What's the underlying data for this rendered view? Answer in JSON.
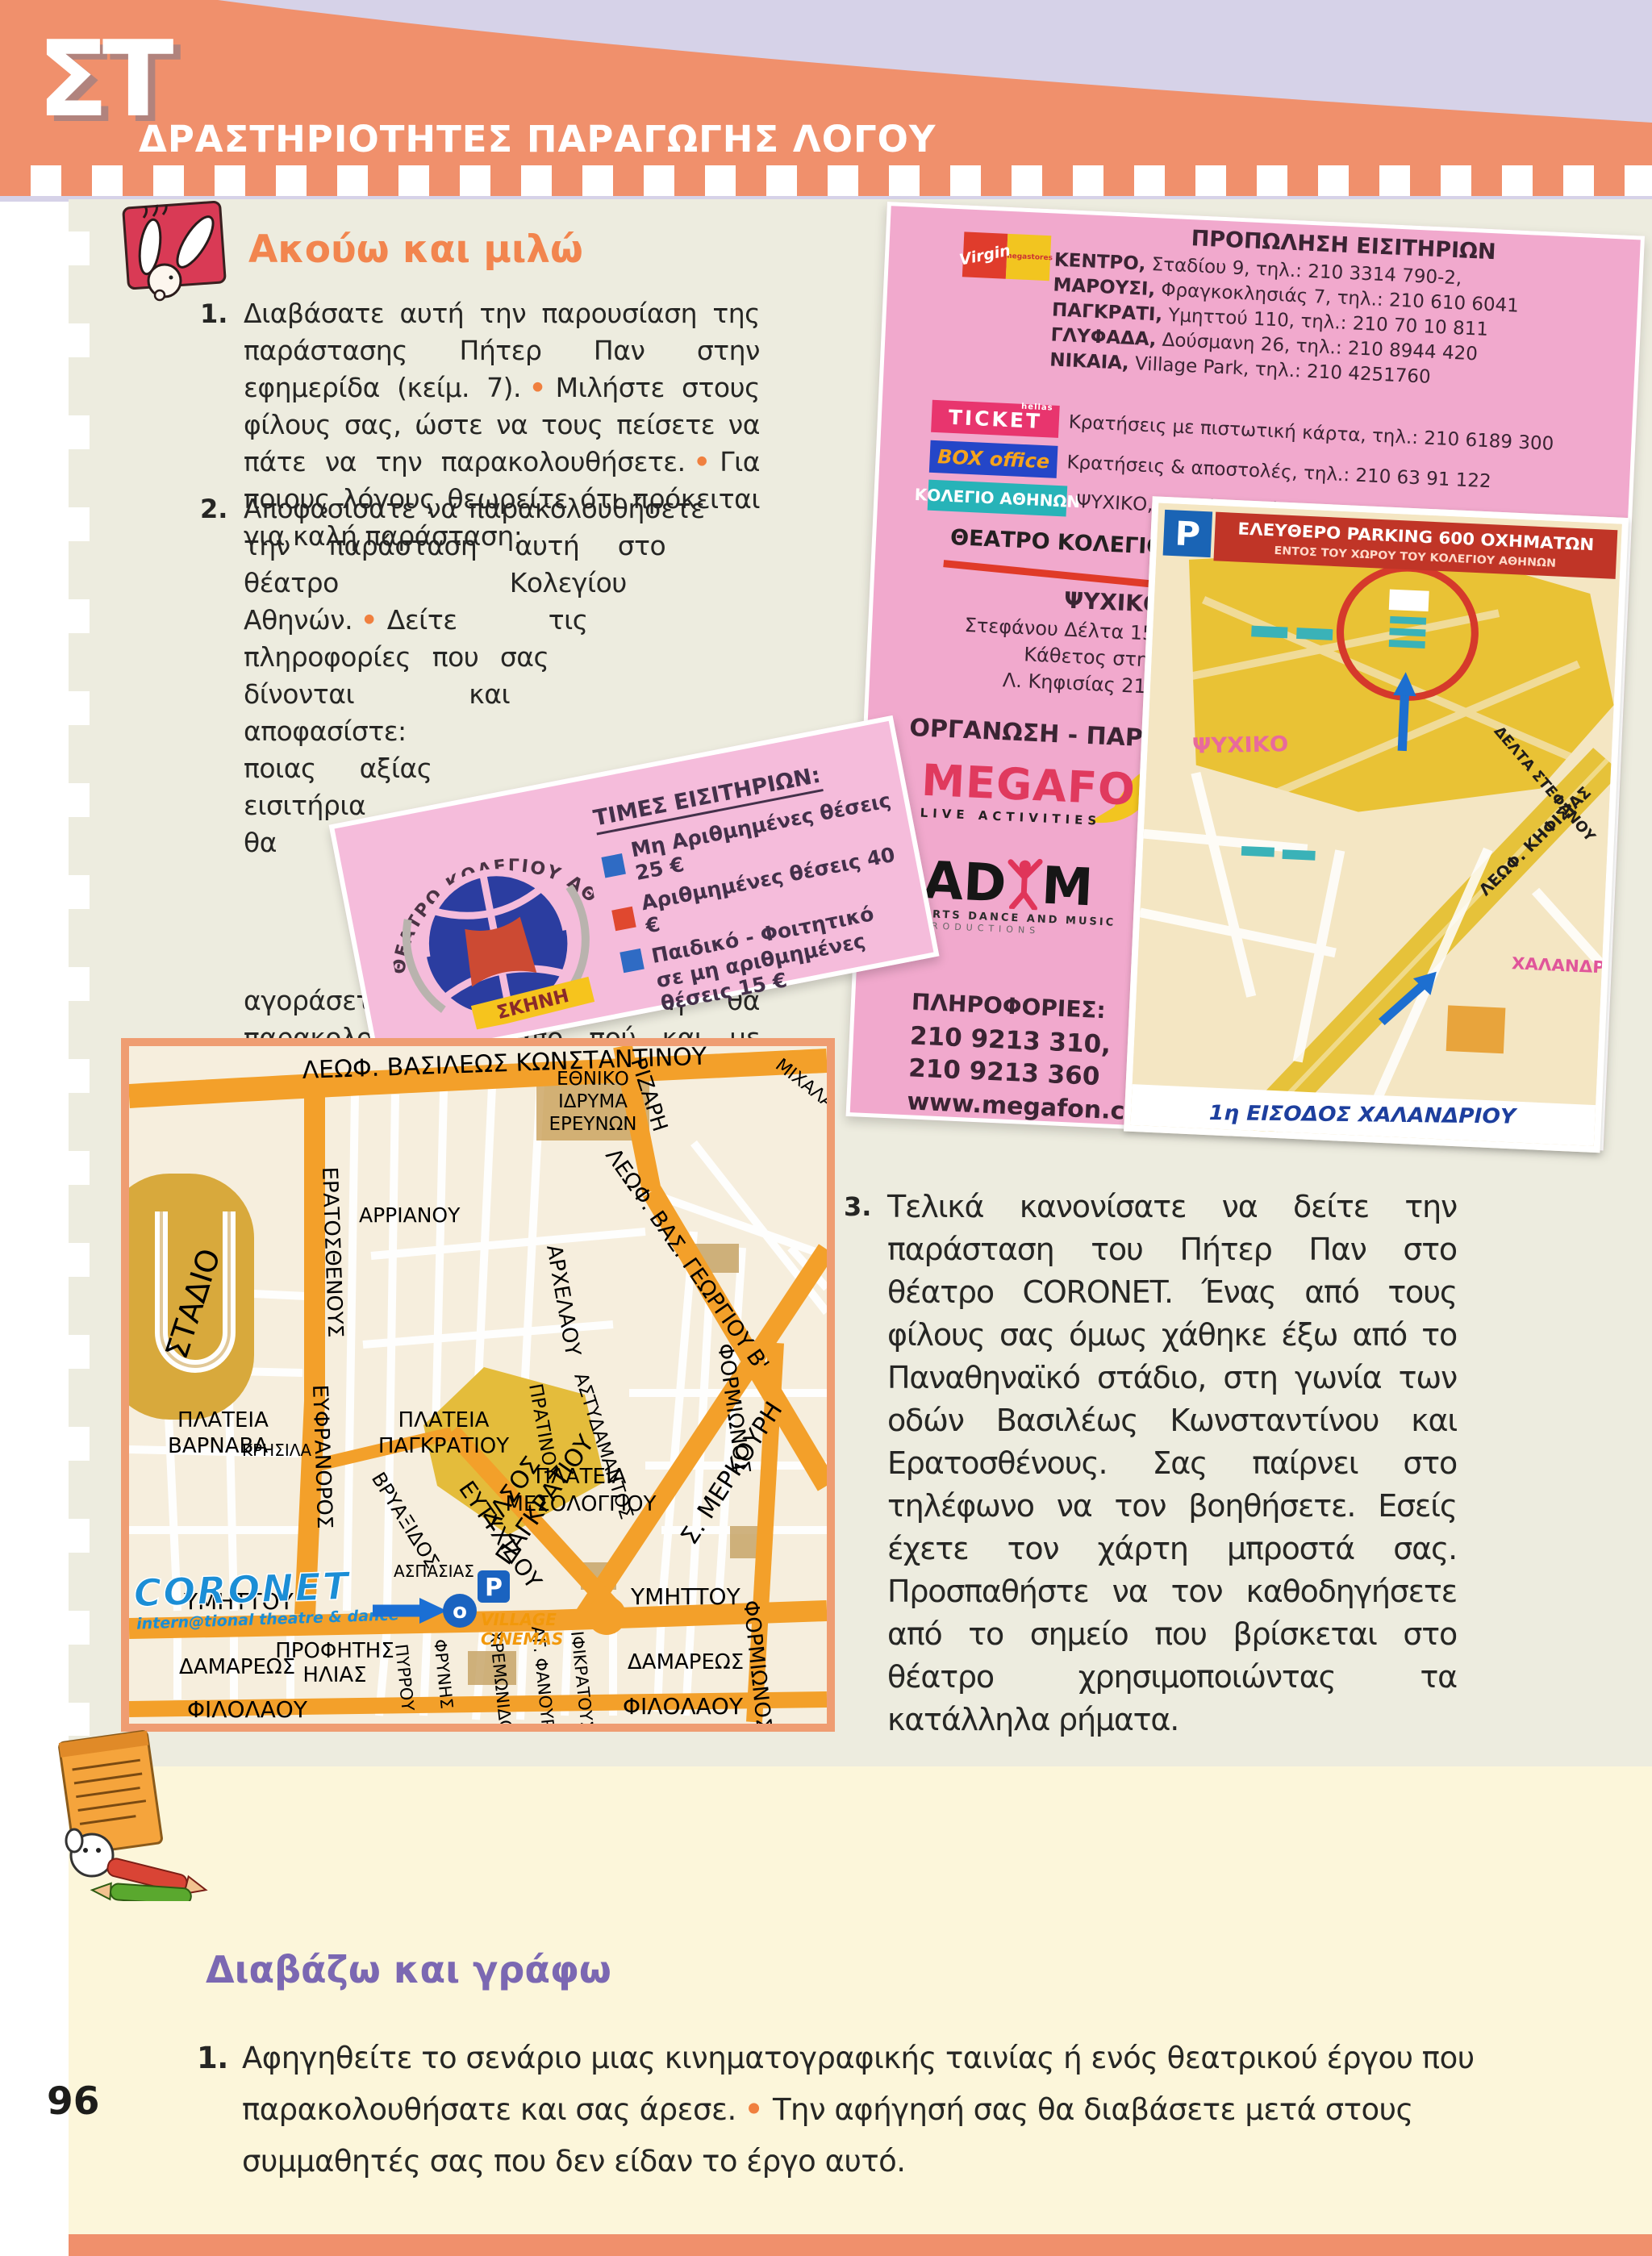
{
  "page": {
    "number": "96"
  },
  "header": {
    "badge": "ΣΤ",
    "title": "ΔΡΑΣΤΗΡΙΟΤΗΤΕΣ ΠΑΡΑΓΩΓΗΣ ΛΟΓΟΥ"
  },
  "listen_speak": {
    "heading": "Ακούω και μιλώ",
    "item1": {
      "num": "1.",
      "p1": "Διαβάσατε αυτή την παρουσίαση της παράστασης Πήτερ Παν στην εφημερίδα (κείμ. 7).",
      "p2": "Μιλήστε στους φίλους σας, ώστε να τους πείσετε να πάτε να την παρακολουθήσετε.",
      "p3": "Για ποιους λόγους θεωρείτε ότι πρόκειται για καλή παράσταση;"
    },
    "item2": {
      "num": "2.",
      "p1": "Αποφασίσατε να παρακολουθήσετε την παράσταση αυτή στο θέατρο Κολεγίου Αθηνών.",
      "p2": "Δείτε τις πληροφορίες που σας δίνονται και αποφασίστε: ποιας αξίας εισιτήρια θα αγοράσετε, ποια παράσταση θα παρακολουθήσετε, από πού και με ποιον τρόπο θα προμηθευτείτε τα εισιτήριά σας."
    },
    "item3": {
      "num": "3.",
      "p1": "Τελικά κανονίσατε να δείτε την παράσταση του Πήτερ Παν στο θέατρο CORONET. Ένας από τους φίλους σας όμως χάθηκε έξω από το Παναθηναϊκό στάδιο, στη γωνία των οδών Βασιλέως Κωνσταντίνου και Ερατοσθένους. Σας παίρνει στο τηλέφωνο να τον βοηθήσετε. Εσείς έχετε τον χάρτη μπροστά σας. Προσπαθήστε να τον καθοδηγήσετε από το σημείο που βρίσκεται στο θέατρο χρησιμοποιώντας τα κατάλληλα ρήματα."
    }
  },
  "flyer": {
    "virgin": {
      "name": "Virgin",
      "sub": "megastores"
    },
    "presale_title": "ΠΡΟΠΩΛΗΣΗ ΕΙΣΙΤΗΡΙΩΝ",
    "loc1": {
      "name": "ΚΕΝΤΡΟ,",
      "rest": " Σταδίου 9, τηλ.: 210 3314 790-2,"
    },
    "loc2": {
      "name": "ΜΑΡΟΥΣΙ,",
      "rest": " Φραγκοκλησιάς 7, τηλ.: 210 610 6041"
    },
    "loc3": {
      "name": "ΠΑΓΚΡΑΤΙ,",
      "rest": " Υμηττού 110, τηλ.: 210 70 10 811"
    },
    "loc4": {
      "name": "ΓΛΥΦΑΔΑ,",
      "rest": " Δούσμανη 26, τηλ.: 210 8944 420"
    },
    "loc5": {
      "name": "ΝΙΚΑΙΑ,",
      "rest": " Village Park, τηλ.: 210 4251760"
    },
    "ticket": {
      "main": "TICKET",
      "sub": "hellas",
      "text": "Κρατήσεις με πιστωτική κάρτα, τηλ.: 210 6189 300"
    },
    "boxoffice": {
      "main": "BOX office",
      "text": "Κρατήσεις & αποστολές, τηλ.: 210 63 91 122"
    },
    "kolegio": {
      "main": "ΚΟΛΕΓΙΟ ΑΘΗΝΩΝ",
      "text": "ΨΥΧΙΚΟ, Στεφάνου Δέλτα 15, τηλ.:210 6798100"
    },
    "theater": {
      "title": "ΘΕΑΤΡΟ ΚΟΛΕΓΙΟΥ ΑΘΗΝΩΝ",
      "area": "ΨΥΧΙΚΟ",
      "a1": "Στεφάνου Δέλτα 15,",
      "a2": "Κάθετος στην",
      "a3": "Λ. Κηφισίας 215"
    },
    "org": "ΟΡΓΑΝΩΣΗ - ΠΑΡΑΓΩΓΗ",
    "megafon": {
      "name": "MEGAFON",
      "sub": "LIVE ACTIVITIES"
    },
    "adam": {
      "a": "AD",
      "m": "M",
      "sub1": "ARTS DANCE AND MUSIC",
      "sub2": "PRODUCTIONS"
    },
    "info": {
      "label": "ΠΛΗΡΟΦΟΡΙΕΣ:",
      "tel1": "210 9213 310,",
      "tel2": "210 9213 360",
      "web": "www.megafon.com"
    },
    "mini_map": {
      "p": "P",
      "parking1": "ΕΛΕΥΘΕΡΟ PARKING 600 ΟΧΗΜΑΤΩΝ",
      "parking2": "ΕΝΤΟΣ ΤΟΥ ΧΩΡΟΥ ΤΟΥ ΚΟΛΕΓΙΟΥ ΑΘΗΝΩΝ",
      "psychiko": "ΨΥΧΙΚΟ",
      "delta": "ΔΕΛΤΑ ΣΤΕΦΑΝΟΥ",
      "kifisias": "ΛΕΩΦ. ΚΗΦΙΣΙΑΣ",
      "chalandri": "ΧΑΛΑΝΔΡΙ",
      "entrance": "1η ΕΙΣΟΔΟΣ ΧΑΛΑΝΔΡΙΟΥ"
    }
  },
  "price_card": {
    "arc_title": "ΘΕΑΤΡΟ ΚΟΛΕΓΙΟΥ ΑΘΗΝΩΝ",
    "stage": "ΣΚΗΝΗ",
    "title": "ΤΙΜΕΣ ΕΙΣΙΤΗΡΙΩΝ:",
    "row1": "Μη Αριθμημένες θέσεις 25 €",
    "row2": "Αριθμημένες θέσεις 40 €",
    "row3a": "Παιδικό - Φοιτητικό",
    "row3b": "σε μη αριθμημένες θέσεις 15 €",
    "colors": {
      "row1": "#2f6bc4",
      "row2": "#e0482f",
      "row3": "#2f6bc4"
    }
  },
  "big_map": {
    "labels": [
      "ΛΕΩΦ. ΒΑΣΙΛΕΩΣ ΚΩΝΣΤΑΝΤΙΝΟΥ",
      "ΕΘΝΙΚΟ",
      "ΙΔΡΥΜΑ",
      "ΕΡΕΥΝΩΝ",
      "ΜΙΧΑΛΑ",
      "ΡΙΖΑΡΗ",
      "ΑΡΡΙΑΝΟΥ",
      "ΣΤΑΔΙΟ",
      "ΕΡΑΤΟΣΘΕΝΟΥΣ",
      "ΛΕΩΦ. ΒΑΣ. ΓΕΩΡΓΙΟΥ Β'",
      "ΑΡΧΕΛΑΟΥ",
      "Σ. ΜΕΡΚΟΥΡΗ",
      "ΠΡΑΤΙΝΟΥ",
      "ΑΣΤΥΔΑΜΑΝΤΟΣ",
      "ΦΟΡΜΙΩΝΟΣ",
      "ΠΛΑΤΕΙΑ",
      "ΒΑΡΝΑΒΑ",
      "ΚΡΗΣΙΛΑ",
      "ΕΥΦΡΑΝΟΡΟΣ",
      "ΠΛΑΤΕΙΑ",
      "ΠΑΓΚΡΑΤΙΟΥ",
      "ΠΛΑΤΕΙΑ",
      "ΜΕΣΟΛΟΓΓΙΟΥ",
      "ΑΛΣΟΣ",
      "ΠΑΓΚΡΑΤΙΟΥ",
      "ΒΡΥΑΞΙΔΟΣ",
      "ΑΣΠΑΣΙΑΣ",
      "ΕΥΤΥΧΙΔΟΥ",
      "ΥΜΗΤΤΟΥ",
      "ΥΜΗΤΤΟΥ",
      "ΠΡΟΦΗΤΗΣ",
      "ΗΛΙΑΣ",
      "ΔΑΜΑΡΕΩΣ",
      "ΔΑΜΑΡΕΩΣ",
      "ΠΥΡΡΟΥ",
      "ΦΡΥΝΗΣ",
      "ΧΡΕΜΩΝΙΔΟΥ",
      "ΑΓ. ΦΑΝΟΥΡΙΟΥ",
      "ΙΦΙΚΡΑΤΟΥΣ",
      "ΦΙΛΟΛΑΟΥ",
      "ΦΙΛΟΛΑΟΥ",
      "ΦΟΡΜΙΩΝΟΣ"
    ],
    "coronet": {
      "name": "CORONET",
      "sub": "intern@tional theatre & dance",
      "village": "VILLAGE",
      "cinemas": "CINEMAS",
      "p": "P",
      "o": "o"
    }
  },
  "read_write": {
    "heading": "Διαβάζω και γράφω",
    "item1": {
      "num": "1.",
      "p1": "Αφηγηθείτε το σενάριο μιας κινηματογραφικής ταινίας ή ενός θεατρικού έργου που παρακολουθήσατε και σας άρεσε.",
      "p2": "Την αφήγησή σας θα διαβάσετε μετά στους συμμαθητές σας που δεν είδαν το έργο αυτό."
    }
  },
  "colors": {
    "banner": "#F0906C",
    "lavender": "#D6D2E8",
    "content_bg": "#EDECDF",
    "bottom_bg": "#FCF6DA",
    "accent_orange": "#F2854E",
    "accent_purple": "#7B68B2",
    "flyer_pink": "#F1A9CD",
    "card_pink": "#F5BCDB",
    "map_road": "#F3A02A",
    "coronet_blue": "#1B8ED6"
  }
}
